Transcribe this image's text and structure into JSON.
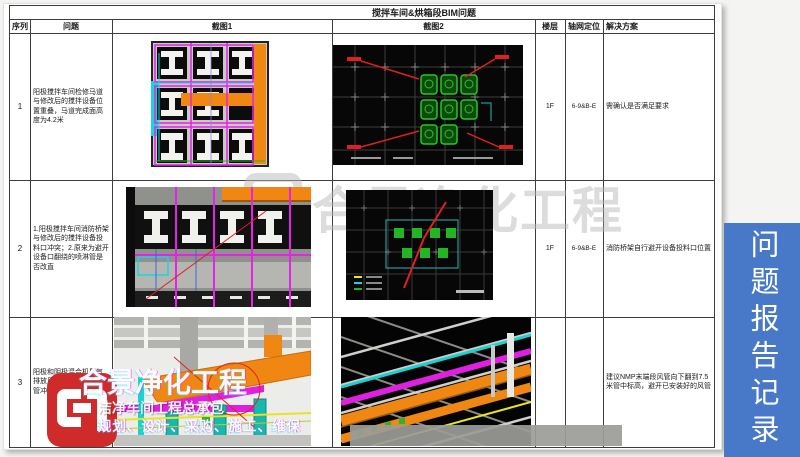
{
  "doc": {
    "title": "搅拌车间&烘箱段BIM问题",
    "headers": {
      "seq": "序列",
      "problem": "问题",
      "shot1": "截图1",
      "shot2": "截图2",
      "floor": "楼层",
      "axis": "轴网定位",
      "solution": "解决方案"
    },
    "rows": [
      {
        "seq": "1",
        "problem": "阳极搅拌车间检修马道与修改后的搅拌设备位置重叠，马道完成面高度为4.2米",
        "floor": "1F",
        "axis": "6-9&B-E",
        "solution": "需确认是否满足要求"
      },
      {
        "seq": "2",
        "problem": "1.阳极搅拌车间消防桥架与修改后的搅拌设备投料口冲突；2.原来为避开设备口翻绕的喷淋管是否改直",
        "floor": "1F",
        "axis": "6-9&B-E",
        "solution": "消防桥架自行避开设备投料口位置"
      },
      {
        "seq": "3",
        "problem": "阳极和阴极混合机尾气排放风管与已安装的风管冲突",
        "floor": "",
        "axis": "",
        "solution": "建议NMP末端段风管向下翻到7.5米管中标高，避开已安装好的风管"
      }
    ]
  },
  "sidebar": {
    "label": "问题报告记录",
    "color": "#4878C8"
  },
  "watermark": {
    "center_text": "合景净化工程",
    "company_name": "合景净化工程",
    "subtitle": "洁净车间工程总承包",
    "slogan": "规划、设计、采购、施工、维保",
    "logo_color": "#CF2B2B"
  }
}
